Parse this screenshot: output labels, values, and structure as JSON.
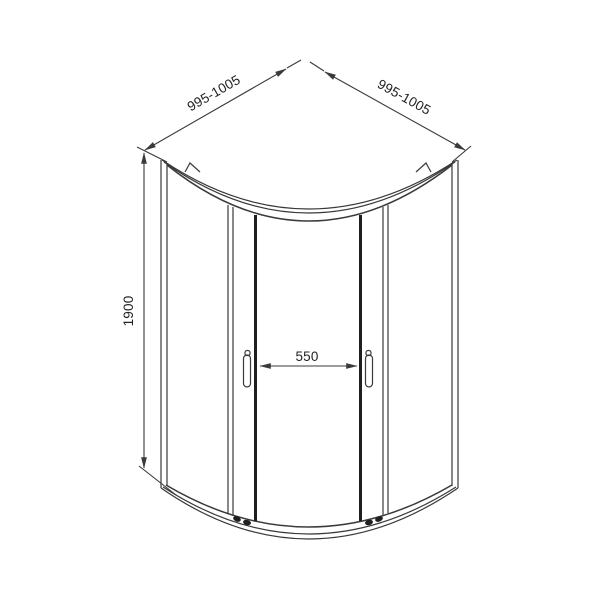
{
  "dimensions": {
    "height": "1900",
    "back_wall_left": "995-1005",
    "back_wall_right": "995-1005",
    "door_opening": "550"
  },
  "colors": {
    "background": "#ffffff",
    "line": "#3a3a3a",
    "thick_line": "#1f1f1f",
    "text": "#222222"
  }
}
